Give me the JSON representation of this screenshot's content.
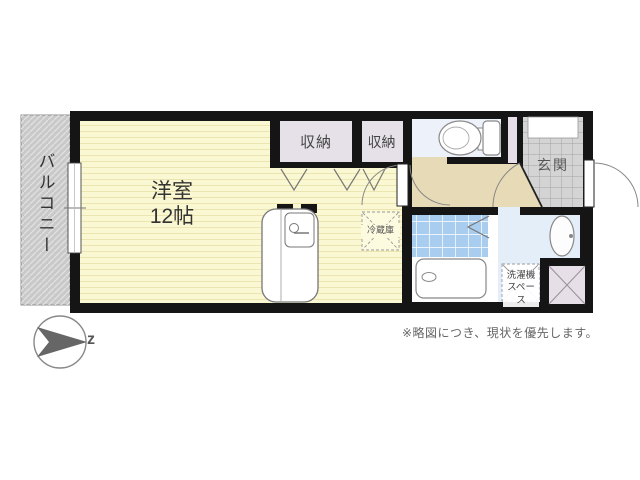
{
  "rooms": {
    "balcony": "バルコニー",
    "main_room": "洋室",
    "main_room_size": "12帖",
    "closet_a": "収納",
    "closet_b": "収納",
    "fridge": "冷蔵庫",
    "entrance": "玄関",
    "laundry_line1": "洗濯機",
    "laundry_line2": "スペース"
  },
  "compass": {
    "letter": "z"
  },
  "note": "※略図につき、現状を優先します。",
  "colors": {
    "wall": "#151515",
    "main_room_fill": "#faf8d2",
    "closet_fill": "#e6e1e9",
    "hallway_fill": "#e7dab6",
    "entrance_tile": "#d4d4d4",
    "bath_tile": "#a9cdee",
    "toilet_floor": "#edf2fa",
    "washroom_floor": "#e4eef8",
    "balcony_fill": "#c9c9c9",
    "pipe_space_fill": "#e6dfe8",
    "fixture_stroke": "#888888"
  }
}
